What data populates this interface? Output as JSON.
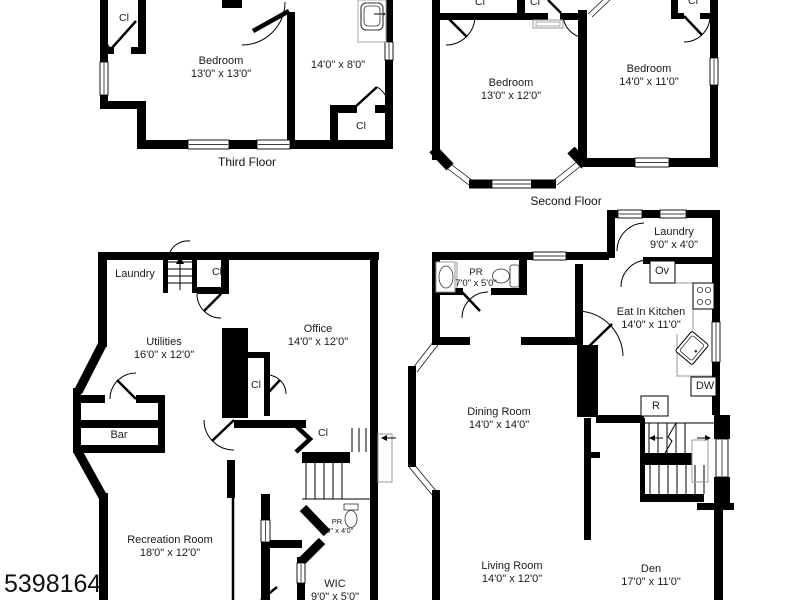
{
  "watermark": "5398164",
  "colors": {
    "wall": "#000000",
    "background": "#ffffff",
    "fixture": "#8a8a8a",
    "text": "#1a1a1a"
  },
  "floors": {
    "third": {
      "label": "Third Floor",
      "rooms": {
        "bedroom": {
          "name": "Bedroom",
          "dims": "13'0\" x 13'0\""
        },
        "side_area": {
          "dims": "14'0\" x 8'0\""
        },
        "closet_top_left": {
          "name": "Cl"
        },
        "closet_bottom_right": {
          "name": "Cl"
        }
      }
    },
    "second": {
      "label": "Second Floor",
      "rooms": {
        "bedroom_left": {
          "name": "Bedroom",
          "dims": "13'0\" x 12'0\""
        },
        "bedroom_right": {
          "name": "Bedroom",
          "dims": "14'0\" x 11'0\""
        },
        "closet_left": {
          "name": "Cl"
        },
        "closet_mid": {
          "name": "Cl"
        },
        "closet_right": {
          "name": "Cl"
        }
      }
    },
    "basement": {
      "rooms": {
        "laundry": {
          "name": "Laundry"
        },
        "closet_stairs": {
          "name": "Cl"
        },
        "utilities": {
          "name": "Utilities",
          "dims": "16'0\" x 12'0\""
        },
        "office": {
          "name": "Office",
          "dims": "14'0\" x 12'0\""
        },
        "closet_office": {
          "name": "Cl"
        },
        "bar": {
          "name": "Bar"
        },
        "closet_hall": {
          "name": "Cl"
        },
        "recreation": {
          "name": "Recreation Room",
          "dims": "18'0\" x 12'0\""
        },
        "powder": {
          "name": "PR",
          "dims": "4'0\" x 4'0\""
        },
        "wic": {
          "name": "WIC",
          "dims": "9'0\" x 5'0\""
        }
      }
    },
    "first": {
      "rooms": {
        "laundry": {
          "name": "Laundry",
          "dims": "9'0\" x 4'0\""
        },
        "oven": {
          "name": "Ov"
        },
        "powder": {
          "name": "PR",
          "dims": "7'0\" x 5'0\""
        },
        "kitchen": {
          "name": "Eat In Kitchen",
          "dims": "14'0\" x 11'0\""
        },
        "dishwasher": {
          "name": "DW"
        },
        "refrigerator": {
          "name": "R"
        },
        "dining": {
          "name": "Dining Room",
          "dims": "14'0\" x 14'0\""
        },
        "living": {
          "name": "Living Room",
          "dims": "14'0\" x 12'0\""
        },
        "den": {
          "name": "Den",
          "dims": "17'0\" x 11'0\""
        }
      }
    }
  }
}
